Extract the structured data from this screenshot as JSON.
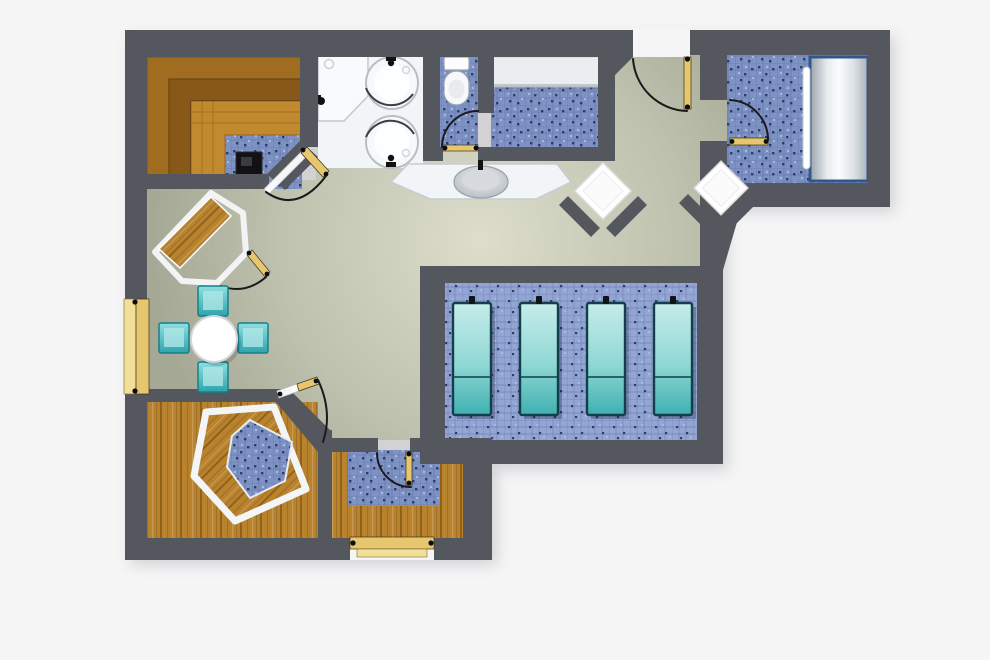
{
  "meta": {
    "title": "Spa wellness suite floor plan (top-down architectural render)",
    "view": "top-down",
    "visible_text": "none"
  },
  "colors": {
    "background": "#f5f5f6",
    "wall": "#55575e",
    "corridor_center": "#dcdecb",
    "corridor_edge": "#a6a896",
    "mosaic_base": "#7e92c4",
    "mosaic_grid": "#56689e",
    "mosaic_dot_dark": "#2e3d68",
    "mosaic_dot_light": "#a9b8e0",
    "mosaic_light_base": "#93a5d2",
    "wood": "#b9822d",
    "wood_dark": "#8a5a16",
    "wood_light": "#d19a44",
    "bench_tier_outer": "#a06c20",
    "bench_tier_mid": "#875818",
    "bench_tier_inner": "#c28a2e",
    "fixture_white": "#f2f5f8",
    "fixture_stroke": "#c3c8cf",
    "bench_white": "#ebeef1",
    "lounger_top": "#c6ecea",
    "lounger_bottom": "#3fb0b2",
    "lounger_border": "#123f4a",
    "chair_border": "#17808a",
    "door_tan": "#e6c76f",
    "door_tan_light": "#f2e09a",
    "glass": "#ffffff",
    "stove": "#121214",
    "tub_blue_border": "#33568f",
    "arc": "#1a1a1a"
  },
  "rooms": [
    {
      "name": "Sauna (top left)",
      "floor": "blue mosaic tile",
      "features": [
        "L-shaped tiered wood bench, 3 tiers",
        "black sauna heater",
        "corner glass swing door"
      ]
    },
    {
      "name": "Shower room",
      "floor": "white",
      "features": [
        "L-shaped vanity counter with faucet",
        "2 round shower basins with curved glass"
      ]
    },
    {
      "name": "WC",
      "floor": "blue mosaic tile",
      "features": [
        "toilet with cistern",
        "swing door to corridor"
      ]
    },
    {
      "name": "Changing room",
      "floor": "blue mosaic tile",
      "features": [
        "long white bench along top wall"
      ]
    },
    {
      "name": "Thermal-bed room (top right)",
      "floor": "blue mosaic tile",
      "features": [
        "large cylindrical thermal bed with grab rail",
        "swing door"
      ]
    },
    {
      "name": "Relaxation terrace (center right)",
      "floor": "light blue mosaic platform",
      "features": [
        "4 teal relaxation loungers"
      ]
    },
    {
      "name": "Whirlpool room (bottom left)",
      "floor": "wood planks",
      "features": [
        "pentagonal wood bench ring",
        "blue mosaic basin center",
        "corner glass swing door"
      ]
    },
    {
      "name": "Shower-cabin room (bottom center)",
      "floor": "wood planks with blue mosaic",
      "features": [
        "U-shaped wood bench",
        "swing door",
        "closed exterior tan door"
      ]
    },
    {
      "name": "Lounge corridor",
      "floor": "green-gray screed",
      "features": [
        "angled corner cabin with wood bench",
        "round table with 4 teal stools",
        "fountain counter with oval basin",
        "2 white diamond corner shelves",
        "main entrance swing door",
        "closed tan double door on left wall"
      ]
    }
  ],
  "furniture_counts": {
    "relax_loungers": 4,
    "table_stools": 4,
    "round_showers": 2,
    "diamond_corner_shelves": 2,
    "sauna_bench_tiers": 3,
    "swing_doors_with_arc": 7,
    "closed_tan_doors": 2
  }
}
